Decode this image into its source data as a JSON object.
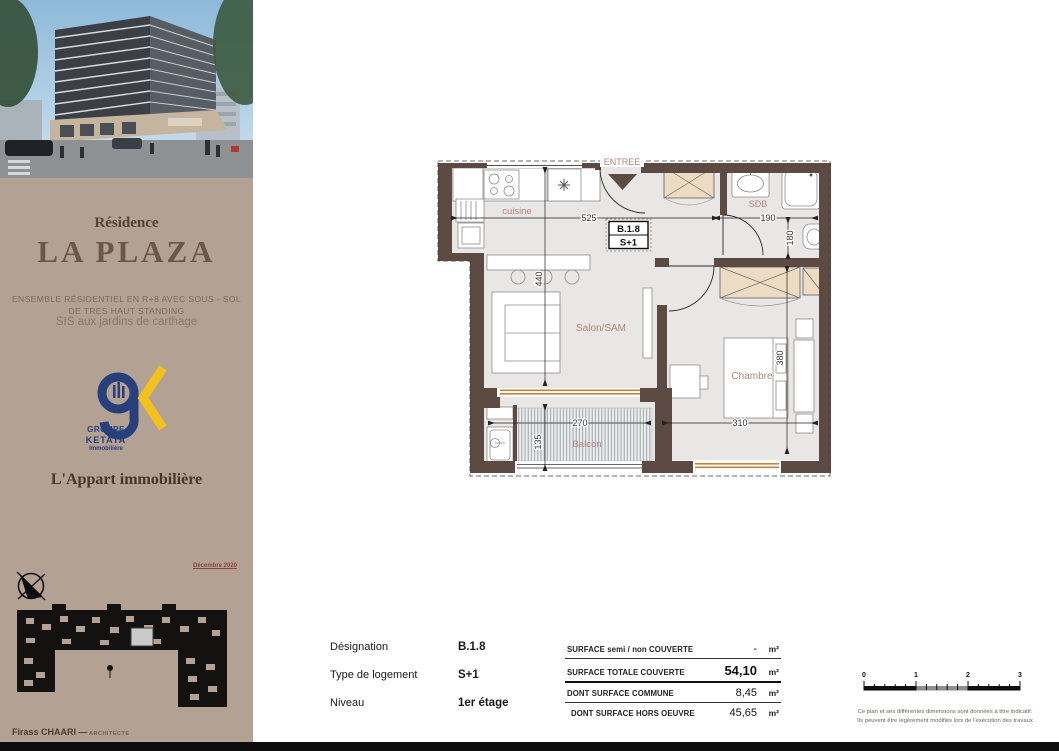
{
  "sidebar": {
    "residence_label": "Résidence",
    "project_name": "LA PLAZA",
    "tagline_line1": "ENSEMBLE RÉSIDENTIEL EN R+8 AVEC SOUS - SOL",
    "tagline_line2": "DE TRES HAUT STANDING",
    "tagline_line3": "SIS aux jardins de carthage",
    "logo_group": "GROUPE",
    "logo_name": "KETATA",
    "logo_subtitle": "Immobilière",
    "agency_name": "L'Appart immobilière",
    "date": "Décembre 2020",
    "architect_name": "Firass CHAARI",
    "architect_dash": "—",
    "architect_title": "ARCHITECTE"
  },
  "plan": {
    "entrance_label": "ENTREE",
    "unit_code": "B.1.8",
    "unit_type": "S+1",
    "room_kitchen": "cuisine",
    "room_bathroom": "SDB",
    "room_living": "Salon/SAM",
    "room_bedroom": "Chambre",
    "room_balcony": "Balcon",
    "dim_kitchen_width": "525",
    "dim_bath_width": "190",
    "dim_bath_height": "180",
    "dim_living_height": "440",
    "dim_bedroom_height": "380",
    "dim_bedroom_width": "310",
    "dim_balcony_width": "270",
    "dim_balcony_height": "135"
  },
  "details": {
    "rows": [
      {
        "label": "Désignation",
        "value": "B.1.8"
      },
      {
        "label": "Type de logement",
        "value": "S+1"
      },
      {
        "label": "Niveau",
        "value": "1er étage"
      }
    ]
  },
  "surfaces": {
    "rows": [
      {
        "label": "SURFACE semi / non COUVERTE",
        "value": "-",
        "unit": "m²"
      },
      {
        "label": "SURFACE TOTALE COUVERTE",
        "value": "54,10",
        "unit": "m²"
      },
      {
        "label": "DONT SURFACE COMMUNE",
        "value": "8,45",
        "unit": "m²"
      },
      {
        "label": "DONT SURFACE HORS OEUVRE",
        "value": "45,65",
        "unit": "m²"
      }
    ]
  },
  "scale": {
    "ticks": [
      "0",
      "1",
      "2",
      "3"
    ]
  },
  "disclaimer": {
    "line1": "Ce plan et ses différentes dimensions sont données à titre indicatif.",
    "line2": "Ils peuvent être légèrement modifiés lors de l'exécution des travaux"
  }
}
